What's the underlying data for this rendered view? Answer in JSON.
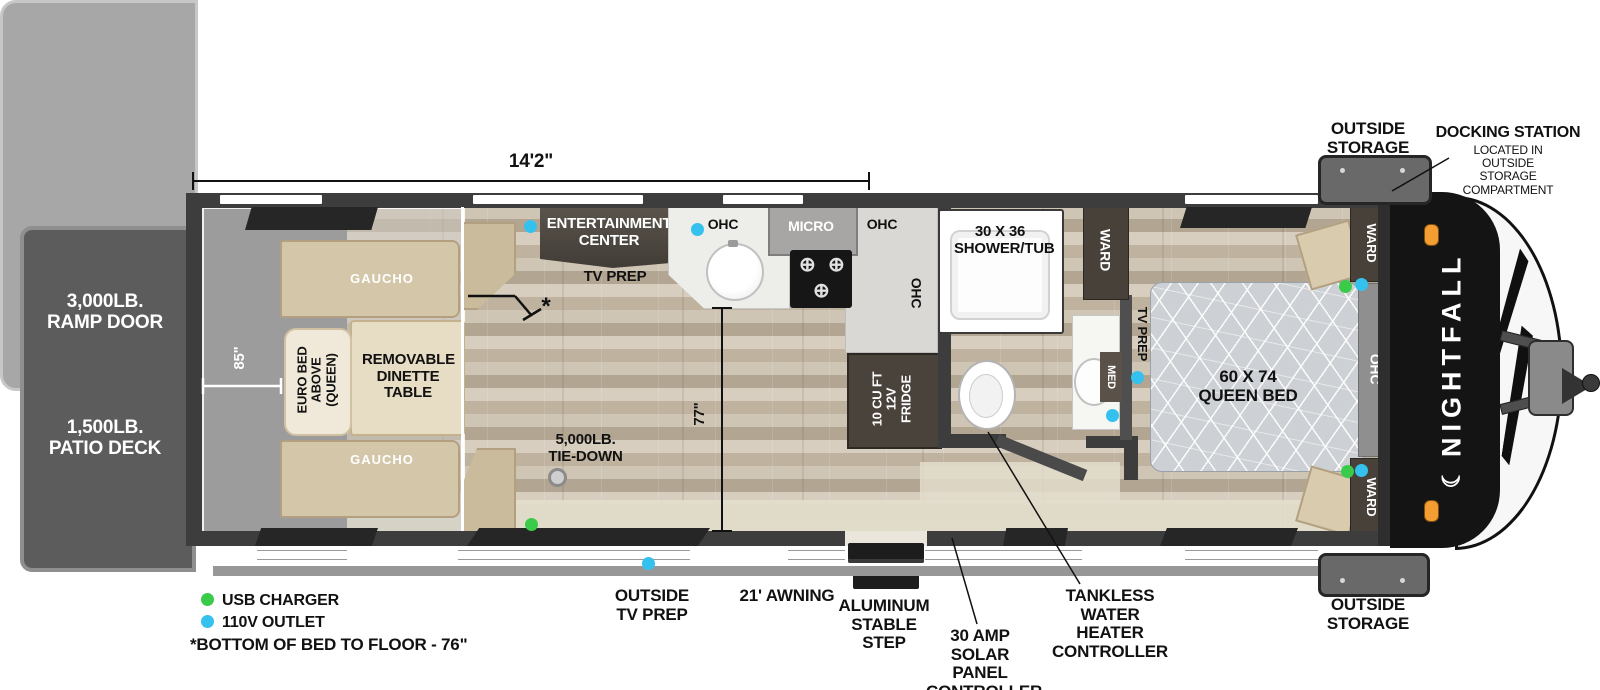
{
  "brand": {
    "name": "NIGHTFALL",
    "moon_icon": "☾"
  },
  "dimensions": {
    "overall_length": "14'2\"",
    "rear_width": "85\"",
    "main_width": "77\""
  },
  "rear": {
    "ramp_door": "3,000LB. RAMP DOOR",
    "patio_deck": "1,500LB. PATIO DECK"
  },
  "garage": {
    "gaucho_top": "GAUCHO",
    "gaucho_bottom": "GAUCHO",
    "euro_bed": "EURO BED ABOVE (QUEEN)",
    "dinette_table": "REMOVABLE DINETTE TABLE",
    "tie_down": "5,000LB. TIE-DOWN",
    "bed_height_marker": "*"
  },
  "living": {
    "entertainment_center": "ENTERTAINMENT CENTER",
    "tv_prep": "TV PREP"
  },
  "kitchen": {
    "ohc_left": "OHC",
    "micro": "MICRO",
    "ohc_right": "OHC",
    "ohc_counter": "OHC",
    "fridge": "10 CU FT 12V FRIDGE"
  },
  "bath": {
    "shower_tub": "30 X 36 SHOWER/TUB",
    "ward": "WARD",
    "med": "MED"
  },
  "bedroom": {
    "tv_prep": "TV PREP",
    "queen_bed": "60 X 74 QUEEN BED",
    "ward_top": "WARD",
    "ward_bottom": "WARD",
    "ohc": "OHC"
  },
  "front": {
    "outside_storage_top": "OUTSIDE STORAGE",
    "outside_storage_bottom": "OUTSIDE STORAGE",
    "docking_title": "DOCKING STATION",
    "docking_sub": "LOCATED IN OUTSIDE STORAGE COMPARTMENT"
  },
  "callouts": {
    "outside_tv_prep": "OUTSIDE TV PREP",
    "awning": "21' AWNING",
    "step": "ALUMINUM STABLE STEP",
    "solar": "30 AMP SOLAR PANEL CONTROLLER",
    "tankless": "TANKLESS WATER HEATER CONTROLLER"
  },
  "legend": {
    "usb": "USB CHARGER",
    "outlet": "110V OUTLET",
    "note": "*BOTTOM OF BED TO FLOOR - 76\""
  },
  "colors": {
    "usb_green": "#3bcb4a",
    "outlet_blue": "#35c1ee"
  }
}
